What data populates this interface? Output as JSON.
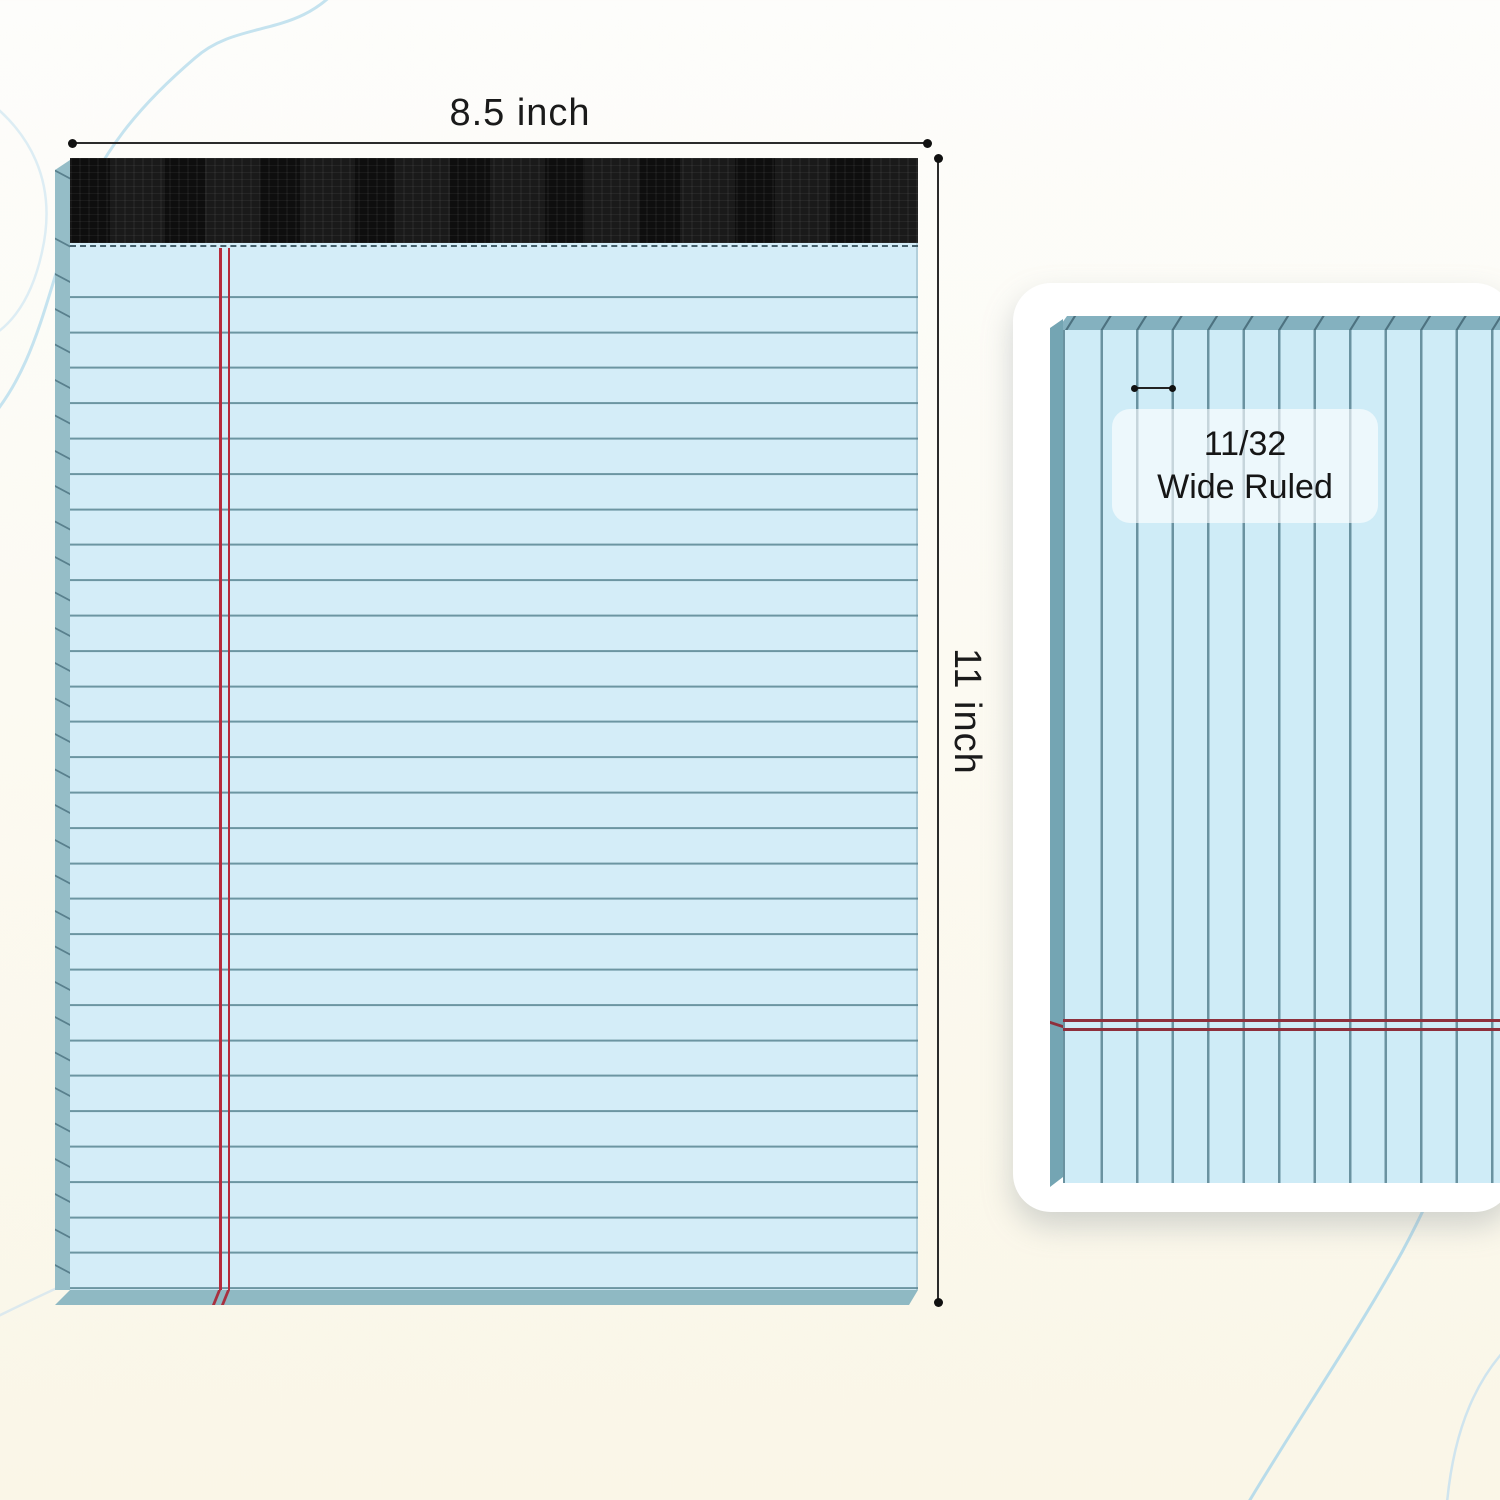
{
  "annotations": {
    "width_label": "8.5 inch",
    "height_label": "11 inch"
  },
  "ruling_detail": {
    "size": "11/32",
    "name": "Wide Ruled"
  },
  "colors": {
    "paper_blue": "#d4edf8",
    "rule_line_blue": "#6c95a2",
    "margin_red": "#b62b3c",
    "detail_rule_red": "#8e2f3c",
    "binding_black": "#1a1a1a",
    "pad_edge_teal": "#8fb9c3",
    "detail_edge_teal": "#74a5b3",
    "card_white": "#ffffff",
    "background_cream": "#faf6e7",
    "accent_curve_blue": "#bcdcea"
  }
}
